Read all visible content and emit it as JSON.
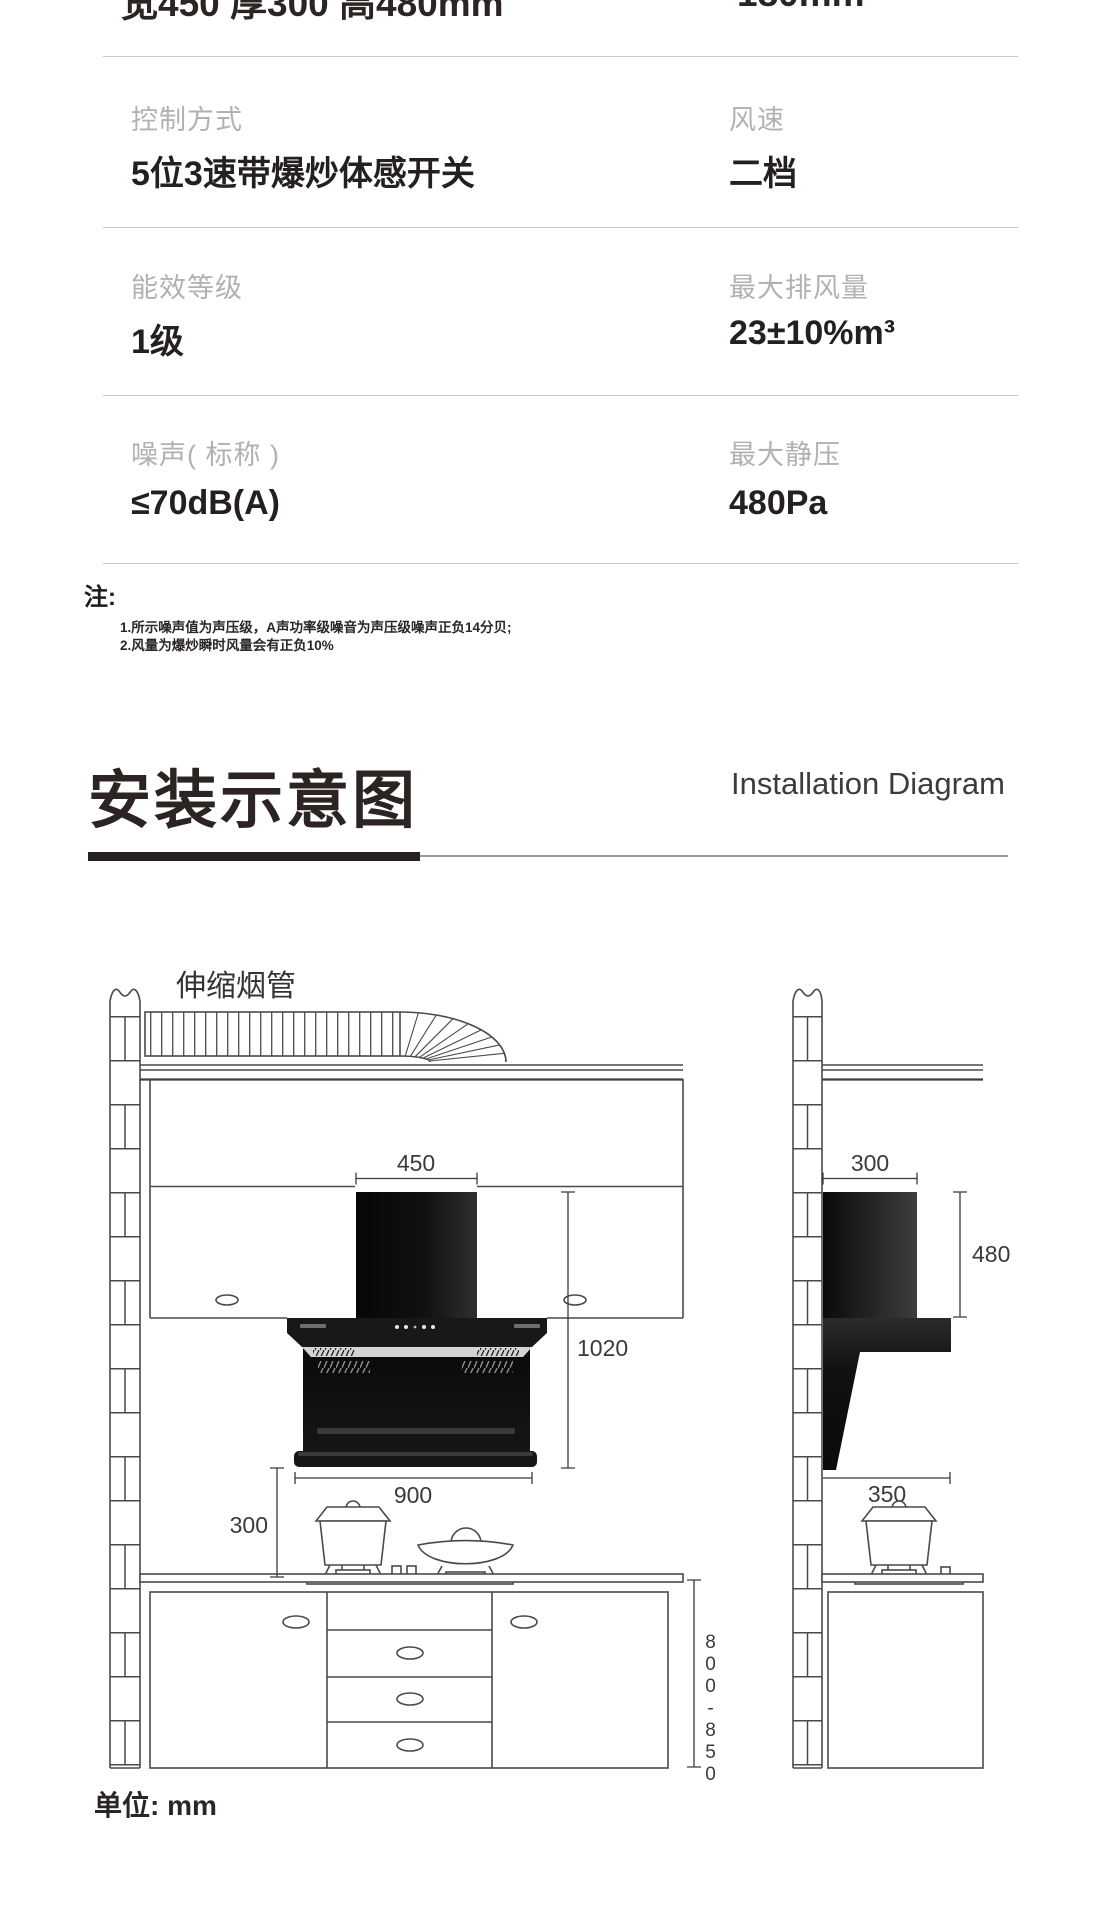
{
  "page": {
    "background": "#ffffff"
  },
  "spec_table": {
    "clipped_row": {
      "left_value": "宽450 厚300 高480mm",
      "right_value": "180mm"
    },
    "rows": [
      {
        "left_label": "控制方式",
        "left_value": "5位3速带爆炒体感开关",
        "right_label": "风速",
        "right_value": "二档"
      },
      {
        "left_label": "能效等级",
        "left_value": "1级",
        "right_label": "最大排风量",
        "right_value": "23±10%m³"
      },
      {
        "left_label": "噪声( 标称 )",
        "left_value": "≤70dB(A)",
        "right_label": "最大静压",
        "right_value": "480Pa"
      }
    ]
  },
  "notes": {
    "heading": "注:",
    "items": [
      "1.所示噪声值为声压级，A声功率级噪音为声压级噪声正负14分贝;",
      "2.风量为爆炒瞬时风量会有正负10%"
    ]
  },
  "section_header": {
    "title_cn": "安装示意图",
    "title_en": "Installation Diagram"
  },
  "diagram": {
    "duct_label": "伸缩烟管",
    "unit_label": "单位: mm",
    "front_view": {
      "chimney_width": "450",
      "hood_height": "1020",
      "hood_width": "900",
      "hood_to_counter": "300",
      "counter_height": "800-850"
    },
    "side_view": {
      "depth_top": "300",
      "chimney_height": "480",
      "body_depth": "350"
    },
    "colors": {
      "line": "#4a4a4a",
      "hood_black": "#101010"
    }
  }
}
